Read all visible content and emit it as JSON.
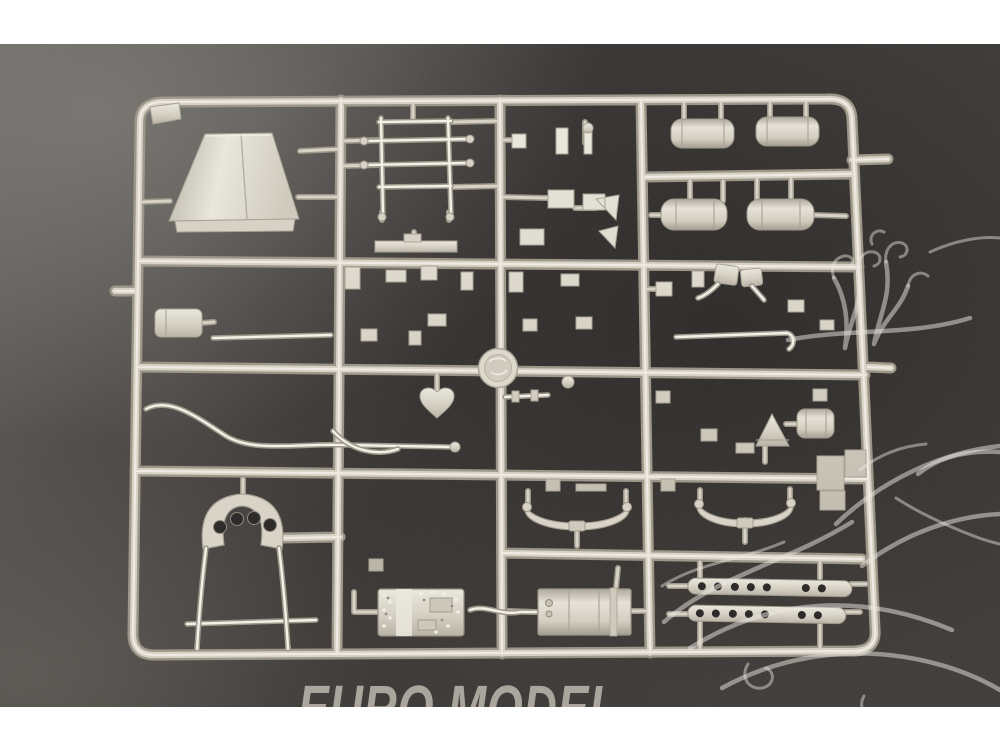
{
  "watermark": {
    "text": "EURO MODEL"
  },
  "logo": {
    "name": "dragon-outline-watermark"
  },
  "photo": {
    "subject": "plastic-model-kit-sprue",
    "parts": [
      "funnel-shroud",
      "corner-plate",
      "ladder-frame",
      "flat-bracket",
      "canister",
      "sway-bar-rod",
      "cab-arch",
      "axle-rod",
      "round-disc",
      "heart-link",
      "engine-block",
      "exhaust-rod",
      "gearbox",
      "leaf-spring-left",
      "leaf-spring-right",
      "fuel-tank-top-left",
      "fuel-tank-top-right",
      "fuel-tank-mid-left",
      "fuel-tank-mid-right",
      "mirror-pair",
      "cone-funnel-small",
      "small-canister",
      "running-board-top",
      "running-board-bottom",
      "small-fittings"
    ]
  },
  "colors": {
    "page-bg": "#ffffff",
    "bg-dark": "#343130",
    "bg-mid": "#4a4744",
    "bg-light": "#6e6b67",
    "plastic": "#d7d2c5",
    "plastic-hl": "#f3f0e8",
    "plastic-shadow": "#a9a396",
    "rail-outline": "#9d978a",
    "wm-line": "#ebe8e2",
    "wm-text": "#c2bdb3"
  }
}
